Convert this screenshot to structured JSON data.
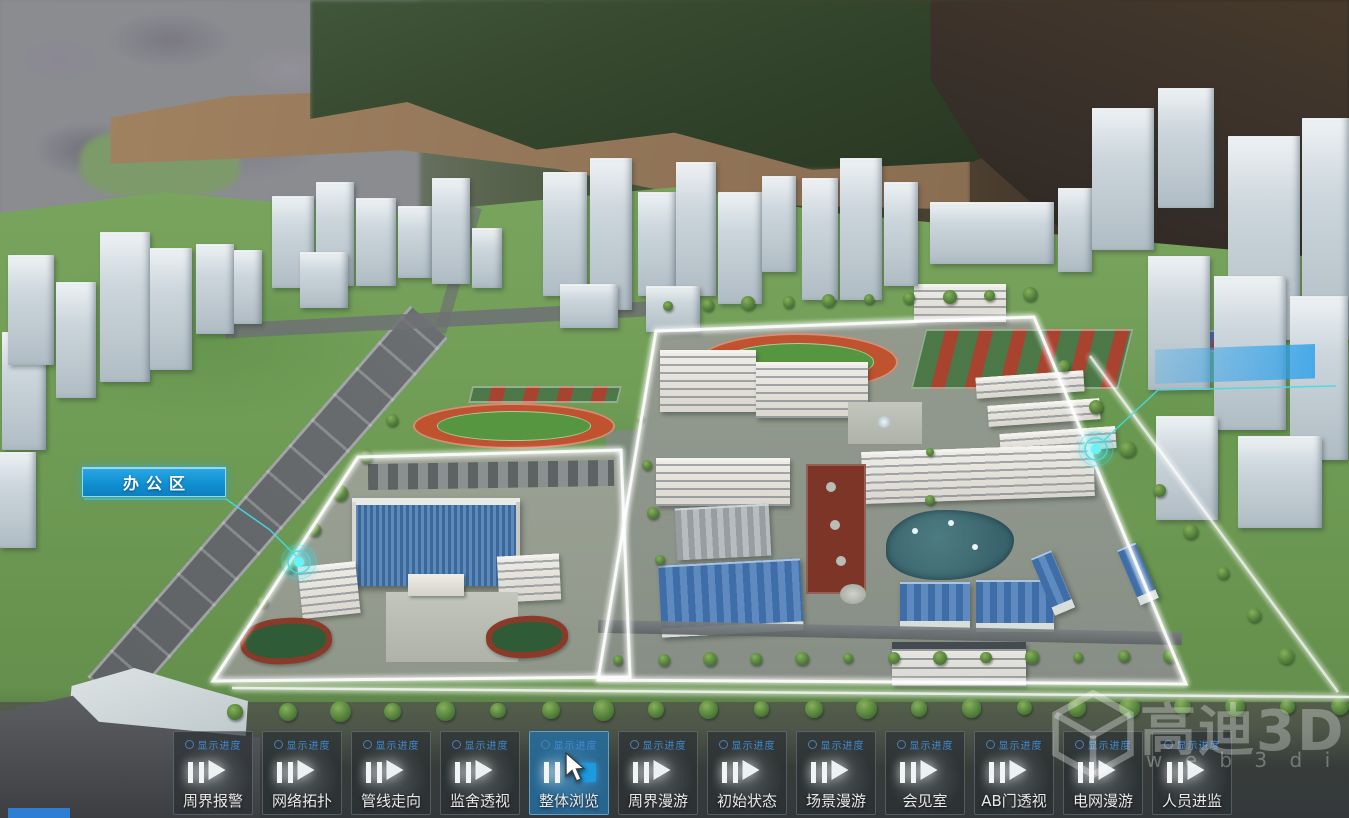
{
  "scene": {
    "area_label": "办公区"
  },
  "watermark": {
    "brand": "高迪3D",
    "domain": "w e b 3 d i . c o m"
  },
  "toolbar": {
    "progress_label": "显示进度",
    "buttons": [
      {
        "label": "周界报警",
        "state": "idle"
      },
      {
        "label": "网络拓扑",
        "state": "idle"
      },
      {
        "label": "管线走向",
        "state": "idle"
      },
      {
        "label": "监舍透视",
        "state": "idle"
      },
      {
        "label": "整体浏览",
        "state": "active"
      },
      {
        "label": "周界漫游",
        "state": "idle"
      },
      {
        "label": "初始状态",
        "state": "idle"
      },
      {
        "label": "场景漫游",
        "state": "idle"
      },
      {
        "label": "会见室",
        "state": "idle"
      },
      {
        "label": "AB门透视",
        "state": "idle"
      },
      {
        "label": "电网漫游",
        "state": "idle"
      },
      {
        "label": "人员进监",
        "state": "idle"
      }
    ]
  },
  "colors": {
    "accent_blue": "#1e9ade",
    "label_box_blue": "#1190d2",
    "marker_cyan": "#43dce4",
    "progress_text_blue": "#3f8ad2",
    "outline_glow": "#ffffff"
  }
}
